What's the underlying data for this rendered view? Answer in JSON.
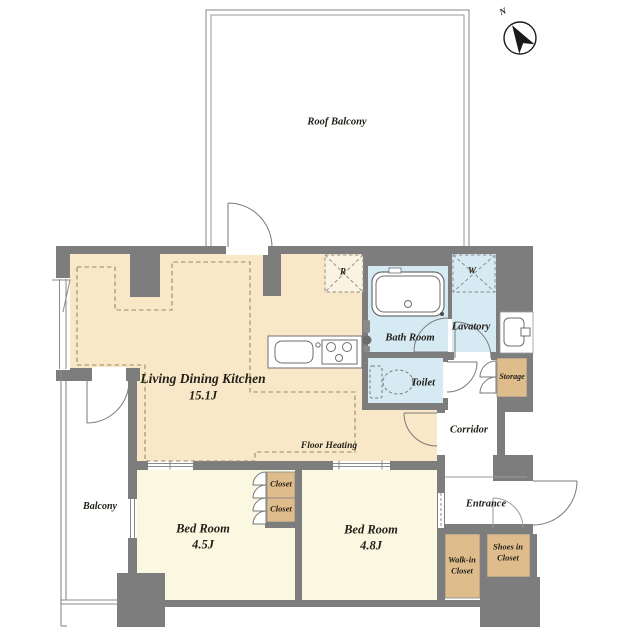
{
  "plan_type": "apartment-floor-plan",
  "compass": {
    "north_label": "N"
  },
  "rooms": {
    "roof_balcony": {
      "name": "Roof Balcony"
    },
    "ldk": {
      "name": "Living Dining Kitchen",
      "size": "15.1J",
      "floor_heating_note": "Floor Heating"
    },
    "bath": {
      "name": "Bath Room"
    },
    "lavatory": {
      "name": "Lavatory"
    },
    "toilet": {
      "name": "Toilet"
    },
    "storage": {
      "name": "Storage"
    },
    "corridor": {
      "name": "Corridor"
    },
    "entrance": {
      "name": "Entrance"
    },
    "balcony": {
      "name": "Balcony"
    },
    "bedroom_small": {
      "name": "Bed Room",
      "size": "4.5J"
    },
    "bedroom_large": {
      "name": "Bed Room",
      "size": "4.8J"
    },
    "closet_upper": {
      "name": "Closet"
    },
    "closet_lower": {
      "name": "Closet"
    },
    "walk_in_closet": {
      "line1": "Walk-in",
      "line2": "Closet"
    },
    "shoes_closet": {
      "line1": "Shoes in",
      "line2": "Closet"
    }
  },
  "appliance_marks": {
    "refrigerator": "R",
    "washing_machine": "W"
  },
  "colors": {
    "wall": "#7d7d7d",
    "ldk_floor": "#f9e8c7",
    "bedroom_floor": "#faf8e0",
    "wet_area_floor": "#d5eaf2",
    "closet_floor": "#dfbc8b",
    "floor_heating_dash": "#9b8a66",
    "text": "#23201a"
  }
}
